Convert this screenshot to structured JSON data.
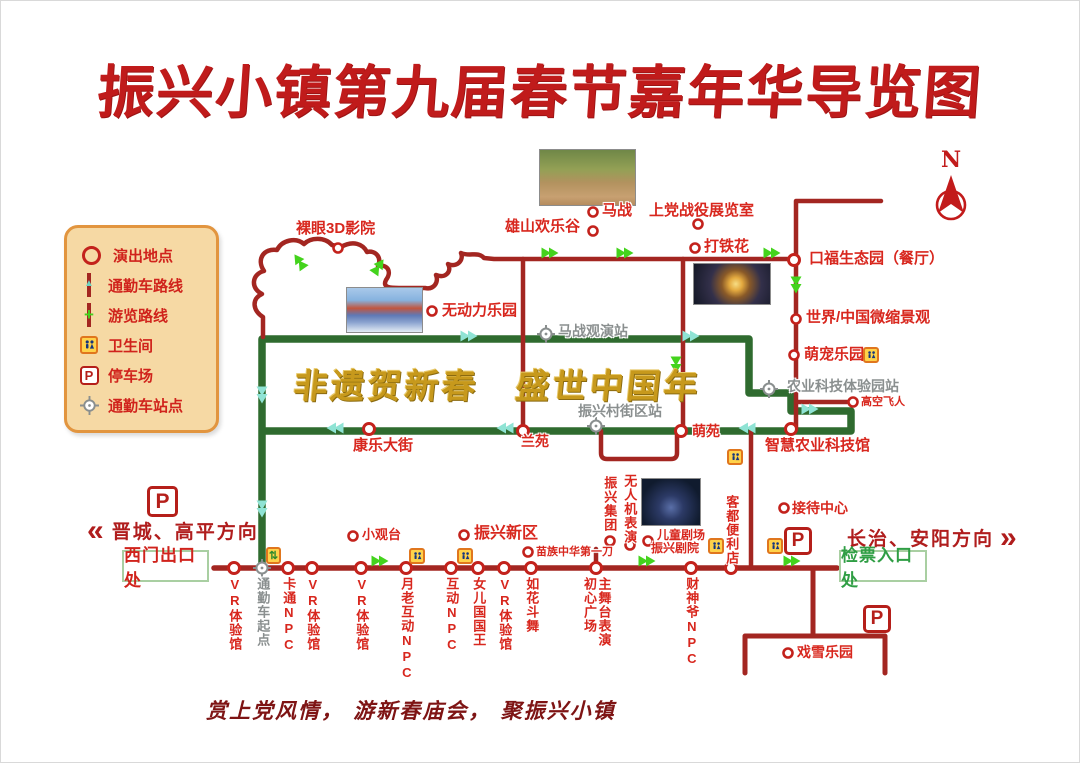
{
  "title": "振兴小镇第九届春节嘉年华导览图",
  "banner": "非遗贺新春　盛世中国年",
  "footer": "赏上党风情， 游新春庙会， 聚振兴小镇",
  "compass": {
    "label": "N"
  },
  "directions": {
    "west": {
      "chevron": "«",
      "text": "晋城、高平方向"
    },
    "east": {
      "text": "长治、安阳方向",
      "chevron": "»"
    }
  },
  "gates": {
    "west": "西门出口处",
    "east": "检票入口处"
  },
  "legend": {
    "items": [
      {
        "icon": "performance-venue-icon",
        "label": "演出地点"
      },
      {
        "icon": "shuttle-route-icon",
        "label": "通勤车路线"
      },
      {
        "icon": "tour-route-icon",
        "label": "游览路线"
      },
      {
        "icon": "toilet-icon",
        "label": "卫生间"
      },
      {
        "icon": "parking-icon",
        "label": "停车场"
      },
      {
        "icon": "shuttle-station-icon",
        "label": "通勤车站点"
      }
    ]
  },
  "colors": {
    "red_route": "#a32621",
    "green_route": "#2f6b2f",
    "red_text": "#d8271e",
    "gray_text": "#8a8f8f",
    "gold": "#c7991c",
    "green_arrow": "#44d31d",
    "cyan_arrow": "#8fe3d4",
    "circle_stroke": "#c3221c"
  },
  "map": {
    "parking_letter": "P",
    "transfer_glyph": "⇅",
    "green_paths": [
      "M261,567 L261,338 L748,338 L748,392 L790,392 L790,410 L850,410 L850,430 L261,430"
    ],
    "red_paths": [
      {
        "d": "M262,336 L262,316 C252,310 250,298 261,293 C249,287 251,273 263,270 C255,258 263,247 276,249 C281,239 295,236 303,243 C310,236 324,236 331,244 L340,246 C352,239 362,243 366,251 C375,249 381,257 377,265 C387,263 391,271 385,279 C381,287 390,287 398,287 L424,287 C433,289 438,281 435,274 C445,278 451,270 447,263 C456,267 463,259 460,252 C469,256 477,250 483,257 L493,258 L795,258",
        "w": 4.5
      },
      {
        "d": "M522,258 L522,430",
        "w": 4.5
      },
      {
        "d": "M682,258 L682,430",
        "w": 4.5
      },
      {
        "d": "M880,200 L795,200 L795,428",
        "w": 4.5
      },
      {
        "d": "M795,401 L849,401",
        "w": 4.5
      },
      {
        "d": "M600,430 L600,452 Q600,458 606,458 L670,458 Q676,458 676,452 L676,430",
        "w": 4.5
      },
      {
        "d": "M595,548 L595,567",
        "w": 4.5
      },
      {
        "d": "M750,430 L750,567",
        "w": 4.5
      },
      {
        "d": "M213,567 L836,567",
        "w": 5.5
      },
      {
        "d": "M812,567 L812,635",
        "w": 5
      },
      {
        "d": "M744,672 L744,635 L884,635 L884,672",
        "w": 5
      }
    ],
    "circles_big": [
      [
        233,
        567
      ],
      [
        287,
        567
      ],
      [
        311,
        567
      ],
      [
        360,
        567
      ],
      [
        405,
        567
      ],
      [
        450,
        567
      ],
      [
        477,
        567
      ],
      [
        503,
        567
      ],
      [
        530,
        567
      ],
      [
        595,
        567
      ],
      [
        690,
        567
      ],
      [
        730,
        567
      ],
      [
        793,
        259
      ],
      [
        522,
        430
      ],
      [
        680,
        430
      ],
      [
        790,
        428
      ],
      [
        368,
        428
      ]
    ],
    "circles_small": [
      [
        592,
        211
      ],
      [
        697,
        223
      ],
      [
        592,
        230
      ],
      [
        694,
        247
      ],
      [
        337,
        247
      ],
      [
        431,
        310
      ],
      [
        795,
        318
      ],
      [
        793,
        354
      ],
      [
        852,
        401
      ],
      [
        352,
        535
      ],
      [
        463,
        534
      ],
      [
        527,
        551
      ],
      [
        609,
        540
      ],
      [
        629,
        544
      ],
      [
        647,
        540
      ],
      [
        783,
        507
      ],
      [
        787,
        652
      ]
    ],
    "crosshairs": [
      [
        261,
        567
      ],
      [
        545,
        333
      ],
      [
        595,
        425
      ],
      [
        768,
        388
      ]
    ],
    "arrows": [
      {
        "x": 296,
        "y": 257,
        "r": -35,
        "c": "g"
      },
      {
        "x": 380,
        "y": 262,
        "r": 35,
        "c": "g"
      },
      {
        "x": 553,
        "y": 252,
        "r": 90,
        "c": "g"
      },
      {
        "x": 628,
        "y": 252,
        "r": 90,
        "c": "g"
      },
      {
        "x": 775,
        "y": 252,
        "r": 90,
        "c": "g"
      },
      {
        "x": 795,
        "y": 288,
        "r": 180,
        "c": "g"
      },
      {
        "x": 675,
        "y": 368,
        "r": 180,
        "c": "g"
      },
      {
        "x": 383,
        "y": 560,
        "r": 90,
        "c": "g"
      },
      {
        "x": 650,
        "y": 560,
        "r": 90,
        "c": "g"
      },
      {
        "x": 795,
        "y": 560,
        "r": 90,
        "c": "g"
      },
      {
        "x": 261,
        "y": 398,
        "r": 180,
        "c": "c"
      },
      {
        "x": 261,
        "y": 512,
        "r": 180,
        "c": "c"
      },
      {
        "x": 330,
        "y": 427,
        "r": -90,
        "c": "c"
      },
      {
        "x": 500,
        "y": 427,
        "r": -90,
        "c": "c"
      },
      {
        "x": 742,
        "y": 427,
        "r": -90,
        "c": "c"
      },
      {
        "x": 472,
        "y": 335,
        "r": 90,
        "c": "c"
      },
      {
        "x": 694,
        "y": 335,
        "r": 90,
        "c": "c"
      },
      {
        "x": 813,
        "y": 408,
        "r": 90,
        "c": "c"
      }
    ],
    "labels": [
      {
        "t": "马战",
        "x": 601,
        "y": 202,
        "s": 15
      },
      {
        "t": "上党战役展览室",
        "x": 648,
        "y": 202,
        "s": 15
      },
      {
        "t": "雄山欢乐谷",
        "x": 504,
        "y": 218,
        "s": 15
      },
      {
        "t": "打铁花",
        "x": 703,
        "y": 238,
        "s": 15
      },
      {
        "t": "裸眼3D影院",
        "x": 295,
        "y": 220,
        "s": 15
      },
      {
        "t": "无动力乐园",
        "x": 441,
        "y": 302,
        "s": 15
      },
      {
        "t": "口福生态园（餐厅）",
        "x": 808,
        "y": 250,
        "s": 15
      },
      {
        "t": "世界/中国微缩景观",
        "x": 805,
        "y": 309,
        "s": 15
      },
      {
        "t": "萌宠乐园",
        "x": 803,
        "y": 346,
        "s": 15
      },
      {
        "t": "高空飞人",
        "x": 860,
        "y": 395,
        "s": 11
      },
      {
        "t": "农业科技体验园站",
        "x": 786,
        "y": 378,
        "s": 14,
        "c": "gray"
      },
      {
        "t": "马战观演站",
        "x": 557,
        "y": 323,
        "s": 14,
        "c": "gray"
      },
      {
        "t": "振兴村街区站",
        "x": 577,
        "y": 403,
        "s": 14,
        "c": "gray"
      },
      {
        "t": "智慧农业科技馆",
        "x": 764,
        "y": 437,
        "s": 15
      },
      {
        "t": "康乐大街",
        "x": 352,
        "y": 437,
        "s": 15
      },
      {
        "t": "兰苑",
        "x": 520,
        "y": 433,
        "s": 14
      },
      {
        "t": "萌苑",
        "x": 691,
        "y": 423,
        "s": 14
      },
      {
        "t": "小观台",
        "x": 361,
        "y": 527,
        "s": 13
      },
      {
        "t": "振兴新区",
        "x": 473,
        "y": 524,
        "s": 16
      },
      {
        "t": "苗族中华第一刀",
        "x": 535,
        "y": 545,
        "s": 11
      },
      {
        "t": "儿童剧场",
        "x": 656,
        "y": 528,
        "s": 12
      },
      {
        "t": "振兴剧院",
        "x": 650,
        "y": 541,
        "s": 12
      },
      {
        "t": "接待中心",
        "x": 791,
        "y": 500,
        "s": 14
      },
      {
        "t": "戏雪乐园",
        "x": 796,
        "y": 644,
        "s": 14
      },
      {
        "t": "VR体验馆",
        "x": 233,
        "y": 576,
        "s": 13,
        "v": 1
      },
      {
        "t": "通勤车起点",
        "x": 261,
        "y": 576,
        "s": 13,
        "v": 1,
        "c": "gray"
      },
      {
        "t": "卡通NPC",
        "x": 287,
        "y": 576,
        "s": 13,
        "v": 1
      },
      {
        "t": "VR体验馆",
        "x": 311,
        "y": 576,
        "s": 13,
        "v": 1
      },
      {
        "t": "VR体验馆",
        "x": 360,
        "y": 576,
        "s": 13,
        "v": 1
      },
      {
        "t": "月老互动NPC",
        "x": 405,
        "y": 576,
        "s": 13,
        "v": 1
      },
      {
        "t": "互动NPC",
        "x": 450,
        "y": 576,
        "s": 13,
        "v": 1
      },
      {
        "t": "女儿国国王",
        "x": 477,
        "y": 576,
        "s": 13,
        "v": 1
      },
      {
        "t": "VR体验馆",
        "x": 503,
        "y": 576,
        "s": 13,
        "v": 1
      },
      {
        "t": "如花斗舞",
        "x": 530,
        "y": 576,
        "s": 13,
        "v": 1
      },
      {
        "t": "初心广场\n主舞台表演",
        "x": 595,
        "y": 576,
        "s": 13,
        "v": 1
      },
      {
        "t": "财神爷NPC",
        "x": 690,
        "y": 576,
        "s": 13,
        "v": 1
      },
      {
        "t": "振兴集团",
        "x": 608,
        "y": 475,
        "s": 13,
        "v": 1
      },
      {
        "t": "无人机表演",
        "x": 628,
        "y": 473,
        "s": 13,
        "v": 1
      },
      {
        "t": "客都便利店",
        "x": 730,
        "y": 494,
        "s": 13,
        "v": 1
      }
    ],
    "photos": [
      {
        "x": 538,
        "y": 148,
        "w": 97,
        "h": 57,
        "kind": "horse-battle"
      },
      {
        "x": 345,
        "y": 286,
        "w": 77,
        "h": 46,
        "kind": "boat"
      },
      {
        "x": 692,
        "y": 262,
        "w": 78,
        "h": 42,
        "kind": "sparks"
      },
      {
        "x": 640,
        "y": 477,
        "w": 60,
        "h": 48,
        "kind": "night"
      }
    ],
    "toilets": [
      [
        408,
        547
      ],
      [
        456,
        547
      ],
      [
        862,
        346
      ],
      [
        726,
        448
      ],
      [
        707,
        537
      ],
      [
        766,
        537
      ]
    ],
    "parkings": [
      {
        "x": 146,
        "y": 485,
        "s": 31
      },
      {
        "x": 783,
        "y": 526,
        "s": 28
      },
      {
        "x": 862,
        "y": 604,
        "s": 28
      }
    ],
    "transfer": [
      [
        265,
        546
      ]
    ]
  }
}
